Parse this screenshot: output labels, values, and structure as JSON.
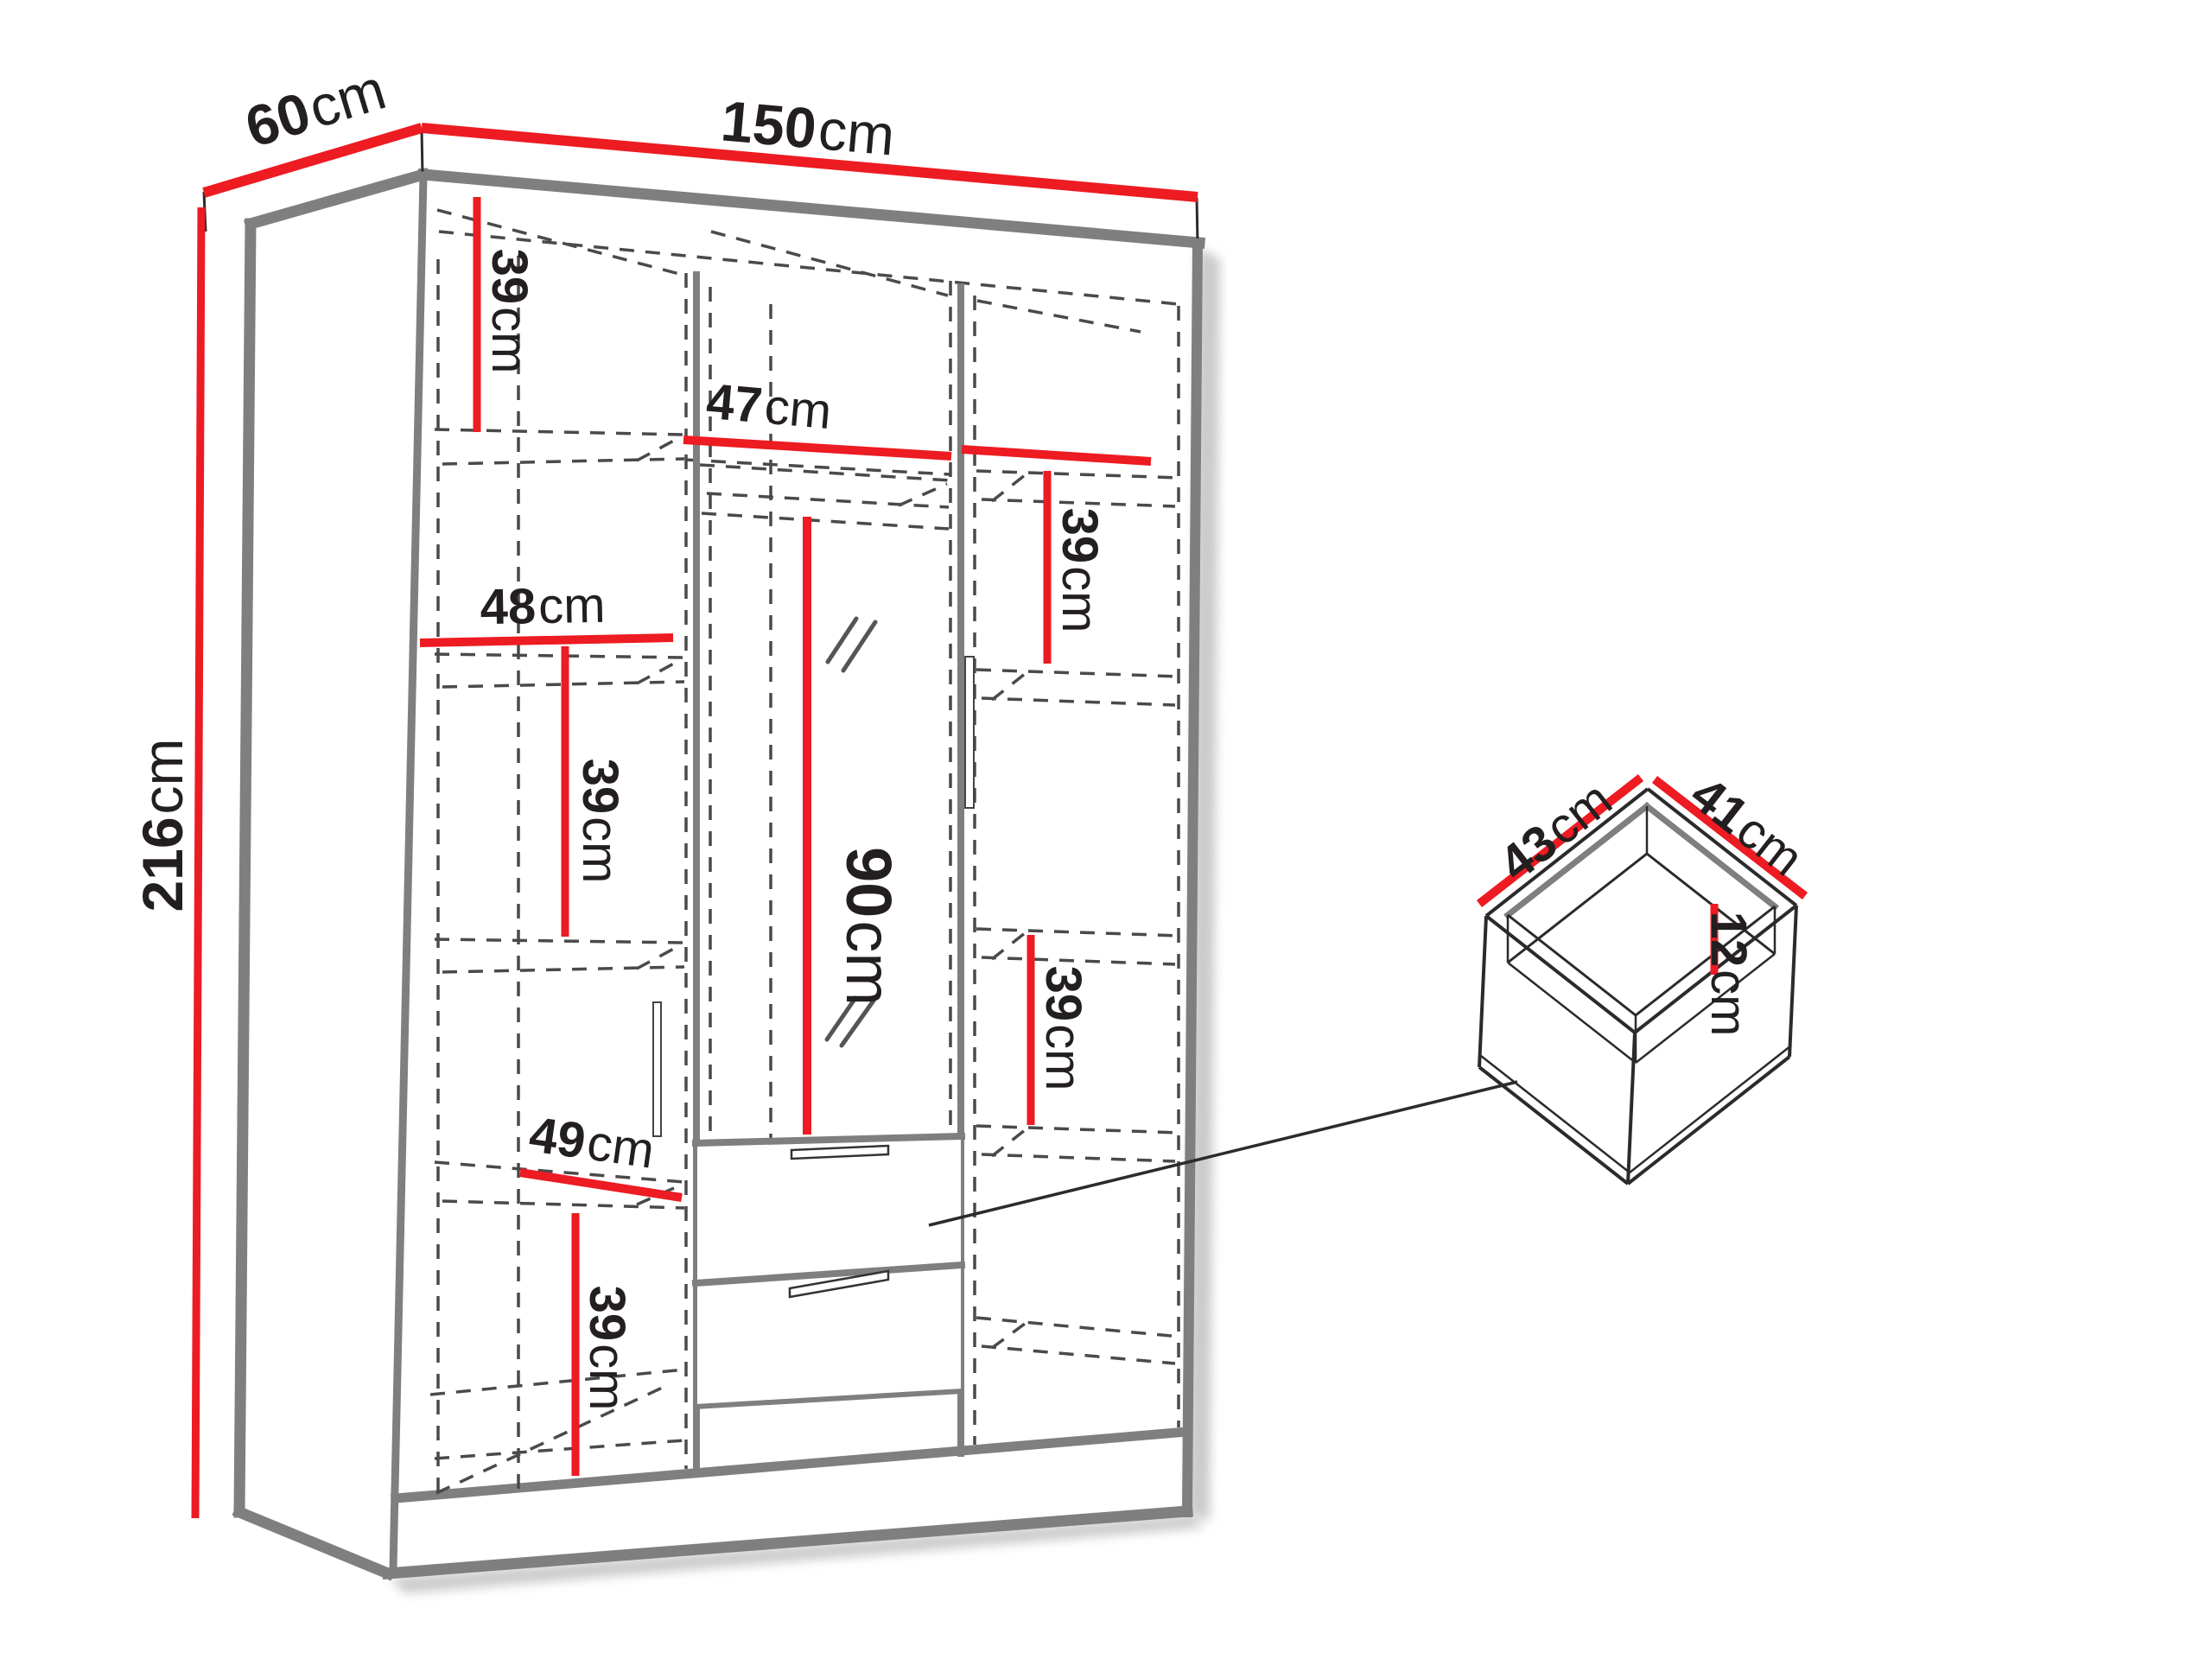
{
  "title": "Wardrobe dimensions diagram",
  "colors": {
    "background": "#FFFFFF",
    "accent_red": "#ED1B22",
    "edge_gray": "#7F7F7F",
    "dash_gray": "#4A4A4A",
    "text": "#231F20",
    "shadow": "#969696"
  },
  "wardrobe": {
    "overall": {
      "width": {
        "value": "150",
        "unit": "cm"
      },
      "depth": {
        "value": "60",
        "unit": "cm"
      },
      "height": {
        "value": "216",
        "unit": "cm"
      }
    },
    "interior": {
      "left_column": {
        "top_section_height": {
          "value": "39",
          "unit": "cm"
        },
        "shelf_width": {
          "value": "48",
          "unit": "cm"
        },
        "middle_section_height": {
          "value": "39",
          "unit": "cm"
        },
        "lower_shelf_width": {
          "value": "49",
          "unit": "cm"
        },
        "bottom_section_height": {
          "value": "39",
          "unit": "cm"
        }
      },
      "middle_column": {
        "top_shelf_width": {
          "value": "47",
          "unit": "cm"
        },
        "hanging_space_height": {
          "value": "90",
          "unit": "cm"
        }
      },
      "right_column": {
        "top_section_height": {
          "value": "39",
          "unit": "cm"
        },
        "middle_section_height": {
          "value": "39",
          "unit": "cm"
        }
      }
    }
  },
  "drawer_detail": {
    "width": {
      "value": "43",
      "unit": "cm"
    },
    "depth": {
      "value": "41",
      "unit": "cm"
    },
    "inner_height": {
      "value": "12",
      "unit": "cm"
    }
  }
}
